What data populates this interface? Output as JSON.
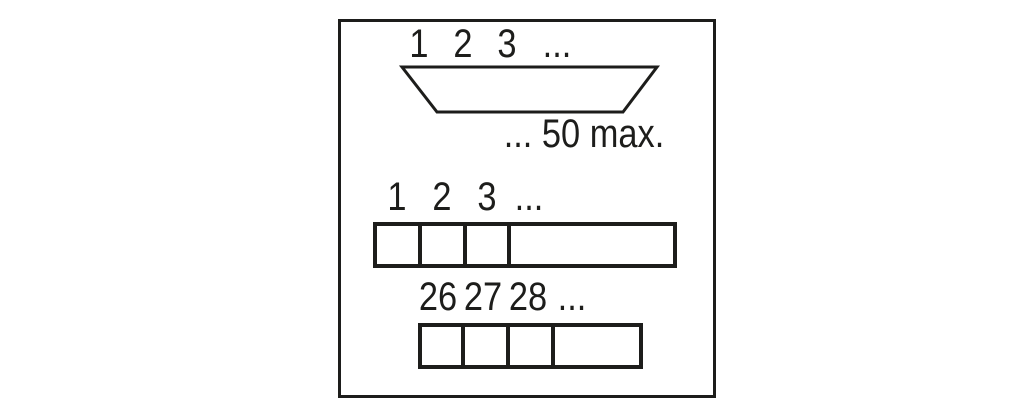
{
  "diagram": {
    "colors": {
      "line": "#1d1d1b",
      "background": "#ffffff"
    },
    "connector": {
      "pin_labels_top": [
        "1",
        "2",
        "3",
        "..."
      ],
      "max_label": "... 50 max."
    },
    "strip1": {
      "labels": [
        "1",
        "2",
        "3",
        "..."
      ],
      "cells": 4
    },
    "strip2": {
      "labels": [
        "26",
        "27",
        "28",
        "..."
      ],
      "cells": 4
    }
  }
}
